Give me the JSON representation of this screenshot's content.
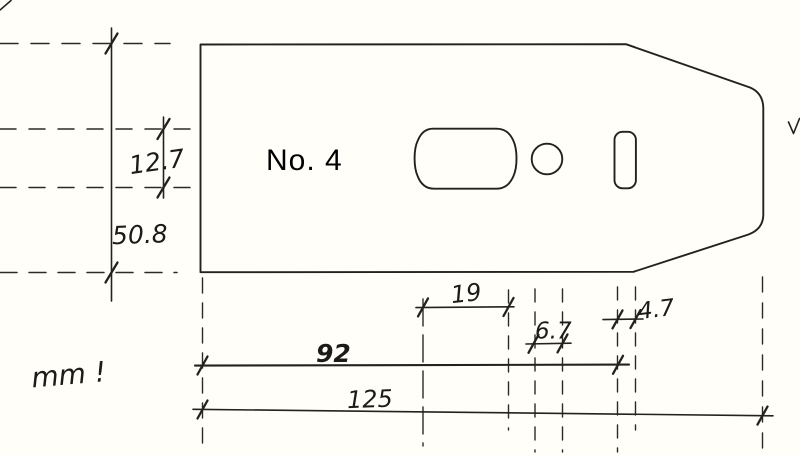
{
  "canvas": {
    "background_color": "#fffef8",
    "ink_color": "#23221f"
  },
  "part": {
    "number_label": "No. 4"
  },
  "notes": {
    "units_note": "mm !"
  },
  "dims": {
    "hole_height": "12.7",
    "blade_width": "50.8",
    "slot_hole_length": "19",
    "round_hole_diameter": "6.7",
    "screw_slot_width": "4.7",
    "edge_to_screw_slot": "92",
    "overall_length": "125"
  }
}
